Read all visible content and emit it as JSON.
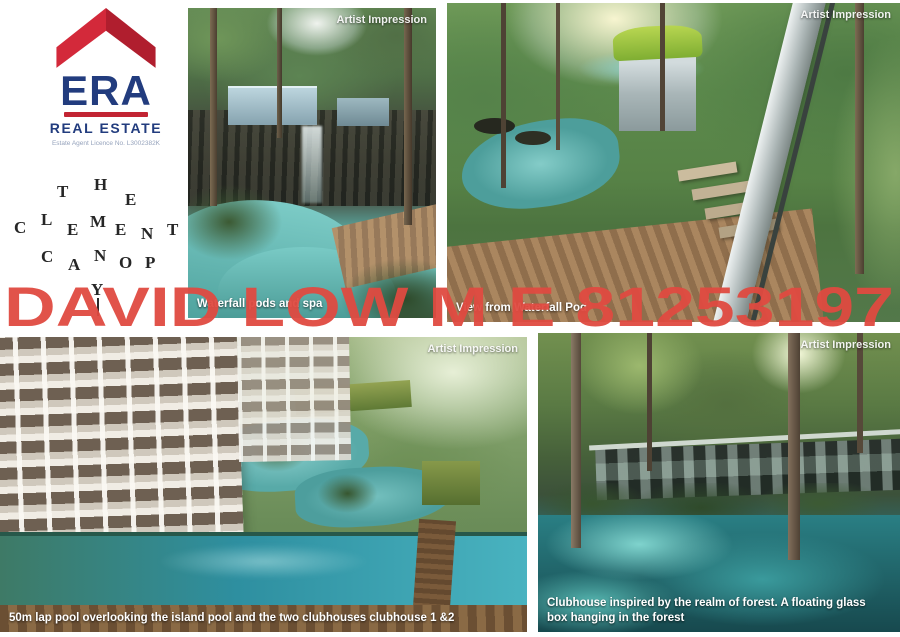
{
  "branding": {
    "era_logo": {
      "name": "ERA",
      "tagline": "REAL ESTATE",
      "licence": "Estate Agent Licence No. L3002382K",
      "brand_red": "#c22433",
      "brand_navy": "#223c7e"
    },
    "canopy_logo": {
      "title": "THE CLEMENT CANOPY",
      "letters": [
        "T",
        "H",
        "E",
        "C",
        "L",
        "E",
        "M",
        "E",
        "N",
        "T",
        "C",
        "A",
        "N",
        "O",
        "P",
        "Y"
      ]
    }
  },
  "watermark": {
    "text": "DAVID LOW M E 81253197",
    "color": "#df4a40"
  },
  "gallery": [
    {
      "name": "waterfall-pods-and-spa",
      "badge": "Artist Impression",
      "caption": "Waterfall pods and spa"
    },
    {
      "name": "view-from-waterfall-pod",
      "badge": "Artist Impression",
      "caption": "View from Waterfall Pod"
    },
    {
      "name": "lap-pool-aerial",
      "badge": "Artist Impression",
      "caption": "50m lap pool overlooking the island pool and the two clubhouses clubhouse 1 &2"
    },
    {
      "name": "forest-clubhouse",
      "badge": "Artist Impression",
      "caption": "Clubhouse inspired by the realm of forest. A floating glass box hanging in the forest"
    }
  ]
}
